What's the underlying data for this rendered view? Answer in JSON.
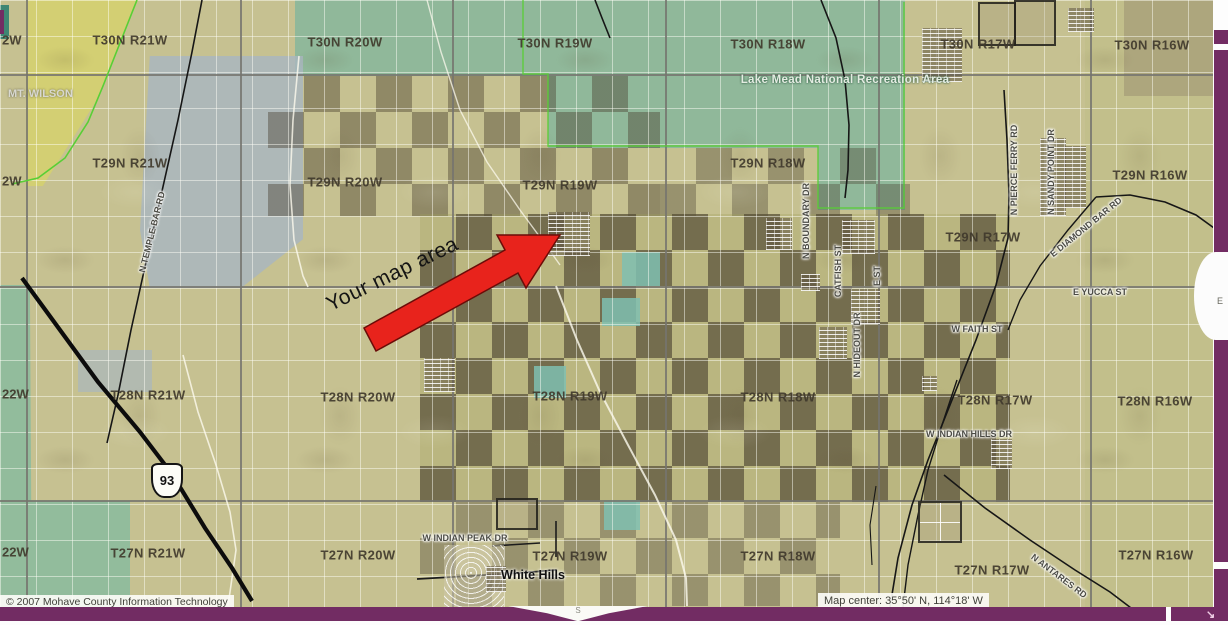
{
  "townships": [
    "T30N R21W",
    "T30N R20W",
    "T30N R19W",
    "T30N R18W",
    "T30N R17W",
    "T30N R16W",
    "T29N R21W",
    "T29N R20W",
    "T29N R19W",
    "T29N R18W",
    "T29N R17W",
    "T29N R16W",
    "T28N R21W",
    "T28N R20W",
    "T28N R19W",
    "T28N R18W",
    "T28N R17W",
    "T28N R16W",
    "T27N R21W",
    "T27N R20W",
    "T27N R19W",
    "T27N R18W",
    "T27N R17W",
    "T27N R16W"
  ],
  "edge_labels": [
    "2W",
    "2W",
    "22W",
    "22W"
  ],
  "road_labels": [
    "N TEMPLE BAR RD",
    "N BOUNDARY DR",
    "CATFISH ST",
    "E ST",
    "N HIDEOUT DR",
    "N PIERCE FERRY RD",
    "N SANDY POINT DR",
    "E DIAMOND BAR RD",
    "E YUCCA ST",
    "W FAITH ST",
    "W INDIAN HILLS DR",
    "W INDIAN PEAK DR",
    "N ANTARES RD"
  ],
  "places": {
    "mt_wilson": "MT. WILSON",
    "nra": "Lake Mead National Recreation Area",
    "white_hills": "White Hills"
  },
  "annotation": {
    "arrow_label": "Your map area"
  },
  "highway": {
    "shield": "93"
  },
  "footer": {
    "copyright": "© 2007 Mohave County Information Technology",
    "map_center": "Map center: 35°50' N, 114°18' W"
  },
  "compass": {
    "east": "E",
    "south": "S"
  },
  "ui": {
    "resize_arrow": "↘"
  },
  "colors": {
    "border_purple": "#722c63",
    "arrow_red": "#e8231c",
    "nra_green": "#7cb49e",
    "land_tan": "#c6c191",
    "grayblue": "#a9b6be",
    "checker_dark": "#42392c"
  }
}
